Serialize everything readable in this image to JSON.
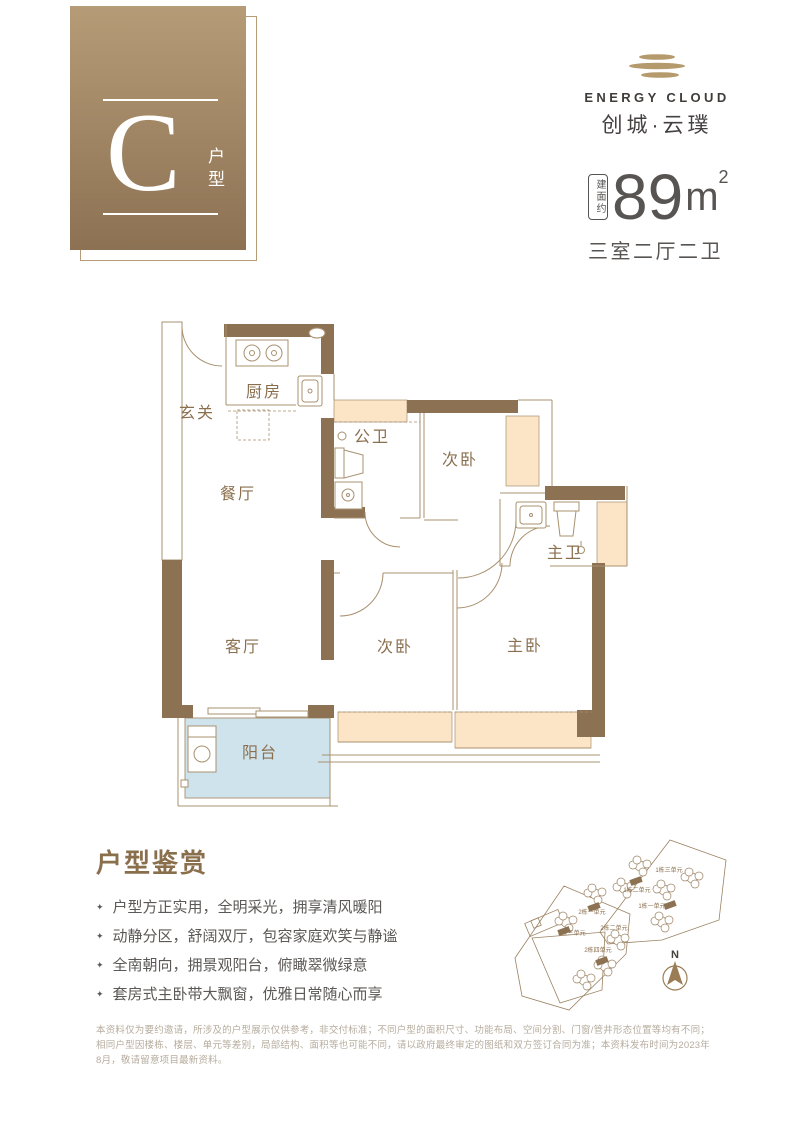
{
  "colors": {
    "wall": "#8c7253",
    "line": "#a8906f",
    "window_fill": "#fbe5c6",
    "balcony_fill": "#cfe3ed",
    "room_label": "#8a6f4e",
    "brand_gold": "#b59a6d",
    "text_dark": "#575452",
    "feature_title": "#8a6f4d",
    "disclaimer": "#b6ac9e",
    "badge_top": "#b59b76",
    "badge_bottom": "#8c7253"
  },
  "unit_badge": {
    "letter": "C",
    "label_vertical": "户型"
  },
  "logo": {
    "name_en": "ENERGY CLOUD",
    "name_cn": "创城·云璞"
  },
  "area_info": {
    "build_label": "建面约",
    "value": "89",
    "unit": "m",
    "sup": "2",
    "layout": "三室二厅二卫"
  },
  "floorplan": {
    "rooms": {
      "entry": "玄关",
      "kitchen": "厨房",
      "guest_bath": "公卫",
      "bedroom_top": "次卧",
      "dining": "餐厅",
      "master_bath": "主卫",
      "living": "客厅",
      "bedroom_mid": "次卧",
      "master_bedroom": "主卧",
      "balcony": "阳台"
    }
  },
  "features": {
    "title": "户型鉴赏",
    "bullet": "✦",
    "items": [
      "户型方正实用，全明采光，拥享清风暖阳",
      "动静分区，舒阔双厅，包容家庭欢笑与静谧",
      "全南朝向，拥景观阳台，俯瞰翠微绿意",
      "套房式主卧带大飘窗，优雅日常随心而享"
    ]
  },
  "siteplan": {
    "compass": "N",
    "labels": [
      "1栋三单元",
      "1栋二单元",
      "1栋一单元",
      "2栋一单元",
      "2栋二单元",
      "2栋三单元",
      "2栋四单元"
    ]
  },
  "disclaimer": "本资料仅为要约邀请，所涉及的户型展示仅供参考，非交付标准；不同户型的面积尺寸、功能布局、空间分割、门窗/管井形态位置等均有不同；相同户型因楼栋、楼层、单元等差别，局部结构、面积等也可能不同，请以政府最终审定的图纸和双方签订合同为准；本资料发布时间为2023年8月，敬请留意项目最新资料。"
}
